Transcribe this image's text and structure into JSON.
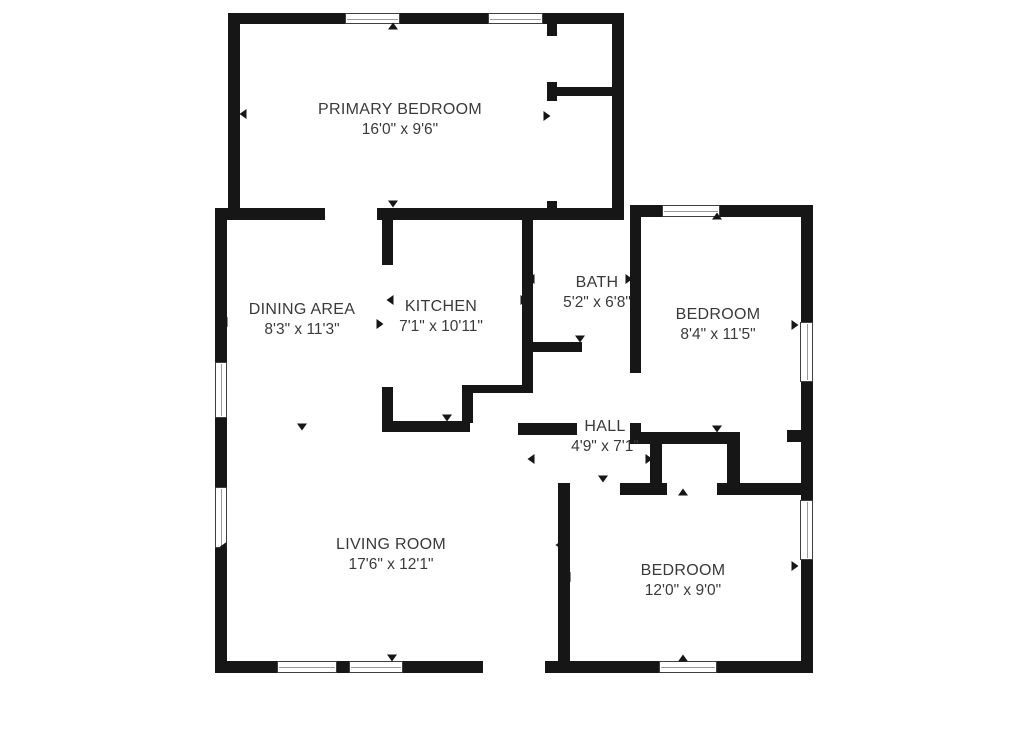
{
  "canvas": {
    "width": 1024,
    "height": 735,
    "background_color": "#ffffff",
    "wall_color": "#161616",
    "text_color": "#3a3a3a",
    "window_border_color": "#3f3f3f",
    "window_pane_color": "#9a9a9a"
  },
  "rooms": [
    {
      "id": "primary-bedroom",
      "name": "PRIMARY BEDROOM",
      "dims": "16'0\" x 9'6\"",
      "cx": 400,
      "cy": 120
    },
    {
      "id": "dining-area",
      "name": "DINING AREA",
      "dims": "8'3\" x 11'3\"",
      "cx": 302,
      "cy": 320
    },
    {
      "id": "kitchen",
      "name": "KITCHEN",
      "dims": "7'1\" x 10'11\"",
      "cx": 441,
      "cy": 317
    },
    {
      "id": "bath",
      "name": "BATH",
      "dims": "5'2\" x 6'8\"",
      "cx": 597,
      "cy": 293
    },
    {
      "id": "bedroom-right",
      "name": "BEDROOM",
      "dims": "8'4\" x 11'5\"",
      "cx": 718,
      "cy": 325
    },
    {
      "id": "hall",
      "name": "HALL",
      "dims": "4'9\" x 7'1\"",
      "cx": 605,
      "cy": 437
    },
    {
      "id": "living-room",
      "name": "LIVING ROOM",
      "dims": "17'6\" x 12'1\"",
      "cx": 391,
      "cy": 555
    },
    {
      "id": "bedroom-bottom",
      "name": "BEDROOM",
      "dims": "12'0\" x 9'0\"",
      "cx": 683,
      "cy": 581
    }
  ],
  "walls": [
    [
      228,
      13,
      117,
      11
    ],
    [
      400,
      13,
      88,
      11
    ],
    [
      543,
      13,
      80,
      11
    ],
    [
      228,
      13,
      12,
      200
    ],
    [
      612,
      13,
      12,
      204
    ],
    [
      547,
      23,
      10,
      13
    ],
    [
      547,
      82,
      10,
      19
    ],
    [
      548,
      87,
      64,
      9
    ],
    [
      547,
      201,
      10,
      11
    ],
    [
      215,
      208,
      110,
      12
    ],
    [
      377,
      208,
      247,
      12
    ],
    [
      633,
      205,
      29,
      12
    ],
    [
      720,
      205,
      81,
      12
    ],
    [
      215,
      208,
      12,
      154
    ],
    [
      215,
      418,
      12,
      69
    ],
    [
      215,
      548,
      12,
      125
    ],
    [
      215,
      661,
      62,
      12
    ],
    [
      337,
      661,
      12,
      12
    ],
    [
      403,
      661,
      80,
      12
    ],
    [
      545,
      661,
      114,
      12
    ],
    [
      717,
      661,
      96,
      12
    ],
    [
      801,
      205,
      12,
      117
    ],
    [
      801,
      382,
      12,
      118
    ],
    [
      801,
      560,
      12,
      113
    ],
    [
      382,
      208,
      11,
      57
    ],
    [
      382,
      387,
      11,
      45
    ],
    [
      382,
      421,
      88,
      11
    ],
    [
      462,
      385,
      11,
      38
    ],
    [
      462,
      385,
      71,
      8
    ],
    [
      522,
      208,
      11,
      185
    ],
    [
      522,
      342,
      60,
      10
    ],
    [
      518,
      423,
      59,
      12
    ],
    [
      630,
      205,
      11,
      168
    ],
    [
      630,
      423,
      11,
      21
    ],
    [
      630,
      432,
      110,
      12
    ],
    [
      787,
      430,
      14,
      12
    ],
    [
      650,
      444,
      12,
      43
    ],
    [
      727,
      444,
      13,
      43
    ],
    [
      558,
      483,
      10,
      12
    ],
    [
      620,
      483,
      47,
      12
    ],
    [
      717,
      483,
      84,
      12
    ],
    [
      558,
      483,
      12,
      190
    ]
  ],
  "windows": [
    {
      "x": 345,
      "y": 13,
      "w": 55,
      "h": 11,
      "o": "h"
    },
    {
      "x": 488,
      "y": 13,
      "w": 55,
      "h": 11,
      "o": "h"
    },
    {
      "x": 662,
      "y": 205,
      "w": 58,
      "h": 12,
      "o": "h"
    },
    {
      "x": 800,
      "y": 322,
      "w": 13,
      "h": 60,
      "o": "v"
    },
    {
      "x": 800,
      "y": 500,
      "w": 13,
      "h": 60,
      "o": "v"
    },
    {
      "x": 215,
      "y": 362,
      "w": 12,
      "h": 56,
      "o": "v"
    },
    {
      "x": 215,
      "y": 487,
      "w": 12,
      "h": 61,
      "o": "v"
    },
    {
      "x": 277,
      "y": 661,
      "w": 60,
      "h": 12,
      "o": "h"
    },
    {
      "x": 349,
      "y": 661,
      "w": 54,
      "h": 12,
      "o": "h"
    },
    {
      "x": 659,
      "y": 661,
      "w": 58,
      "h": 12,
      "o": "h"
    }
  ],
  "markers": [
    {
      "x": 393,
      "y": 26,
      "dir": "up"
    },
    {
      "x": 243,
      "y": 114,
      "dir": "left"
    },
    {
      "x": 547,
      "y": 116,
      "dir": "right"
    },
    {
      "x": 302,
      "y": 213,
      "dir": "up"
    },
    {
      "x": 393,
      "y": 204,
      "dir": "down"
    },
    {
      "x": 447,
      "y": 213,
      "dir": "up"
    },
    {
      "x": 582,
      "y": 213,
      "dir": "up"
    },
    {
      "x": 717,
      "y": 216,
      "dir": "up"
    },
    {
      "x": 224,
      "y": 322,
      "dir": "left"
    },
    {
      "x": 390,
      "y": 300,
      "dir": "left"
    },
    {
      "x": 380,
      "y": 324,
      "dir": "right"
    },
    {
      "x": 531,
      "y": 279,
      "dir": "left"
    },
    {
      "x": 524,
      "y": 300,
      "dir": "right"
    },
    {
      "x": 629,
      "y": 279,
      "dir": "right"
    },
    {
      "x": 637,
      "y": 323,
      "dir": "left"
    },
    {
      "x": 580,
      "y": 339,
      "dir": "down"
    },
    {
      "x": 447,
      "y": 418,
      "dir": "down"
    },
    {
      "x": 302,
      "y": 427,
      "dir": "down"
    },
    {
      "x": 531,
      "y": 459,
      "dir": "left"
    },
    {
      "x": 649,
      "y": 459,
      "dir": "right"
    },
    {
      "x": 603,
      "y": 479,
      "dir": "down"
    },
    {
      "x": 683,
      "y": 492,
      "dir": "up"
    },
    {
      "x": 717,
      "y": 429,
      "dir": "down"
    },
    {
      "x": 559,
      "y": 545,
      "dir": "left"
    },
    {
      "x": 567,
      "y": 577,
      "dir": "left"
    },
    {
      "x": 795,
      "y": 325,
      "dir": "right"
    },
    {
      "x": 795,
      "y": 566,
      "dir": "right"
    },
    {
      "x": 683,
      "y": 658,
      "dir": "up"
    },
    {
      "x": 392,
      "y": 658,
      "dir": "down"
    },
    {
      "x": 223,
      "y": 547,
      "dir": "left"
    }
  ]
}
